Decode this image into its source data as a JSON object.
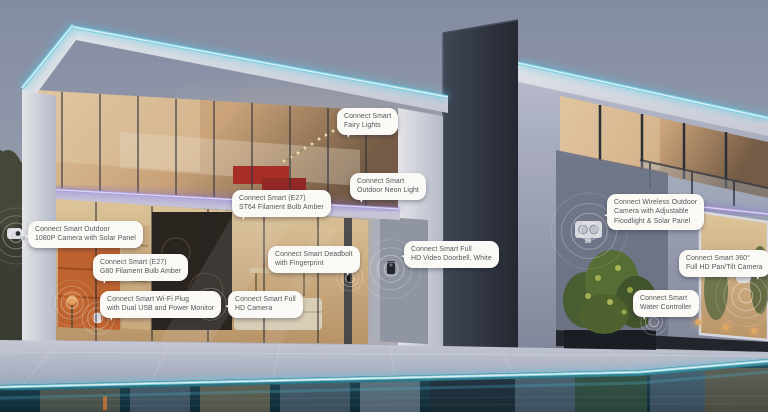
{
  "colors": {
    "led_cyan": "#5fd8f2",
    "led_purple": "#9b84e8",
    "pool_teal": "#2b7b85",
    "bubble_background": "#fbf9f6",
    "bubble_text": "#55565a"
  },
  "callouts": [
    {
      "device": "outdoor-camera-solar",
      "lines": [
        "Connect Smart Outdoor",
        "1080P Camera with Solar Panel"
      ]
    },
    {
      "device": "g80-filament-bulb",
      "lines": [
        "Connect Smart (E27)",
        "G80 Filament Bulb Amber"
      ]
    },
    {
      "device": "wifi-plug",
      "lines": [
        "Connect Smart Wi-Fi Plug",
        "with Dual USB and Power Monitor"
      ]
    },
    {
      "device": "st64-filament-bulb",
      "lines": [
        "Connect Smart (E27)",
        "ST64 Filament Bulb Amber"
      ]
    },
    {
      "device": "deadbolt",
      "lines": [
        "Connect Smart Deadbolt",
        "with Fingerprint"
      ]
    },
    {
      "device": "full-hd-camera",
      "lines": [
        "Connect Smart Full",
        "HD Camera"
      ]
    },
    {
      "device": "fairy-lights",
      "lines": [
        "Connect Smart",
        "Fairy Lights"
      ]
    },
    {
      "device": "outdoor-neon-light",
      "lines": [
        "Connect Smart",
        "Outdoor Neon Light"
      ]
    },
    {
      "device": "video-doorbell",
      "lines": [
        "Connect Smart Full",
        "HD Video Doorbell, White"
      ]
    },
    {
      "device": "wireless-floodlight-camera",
      "lines": [
        "Connect Wireless Outdoor",
        "Camera with Adjustable",
        "Floodlight & Solar Panel"
      ]
    },
    {
      "device": "pan-tilt-camera",
      "lines": [
        "Connect Smart 360°",
        "Full HD Pan/Tilt Camera"
      ]
    },
    {
      "device": "water-controller",
      "lines": [
        "Connect Smart",
        "Water Controller"
      ]
    }
  ]
}
